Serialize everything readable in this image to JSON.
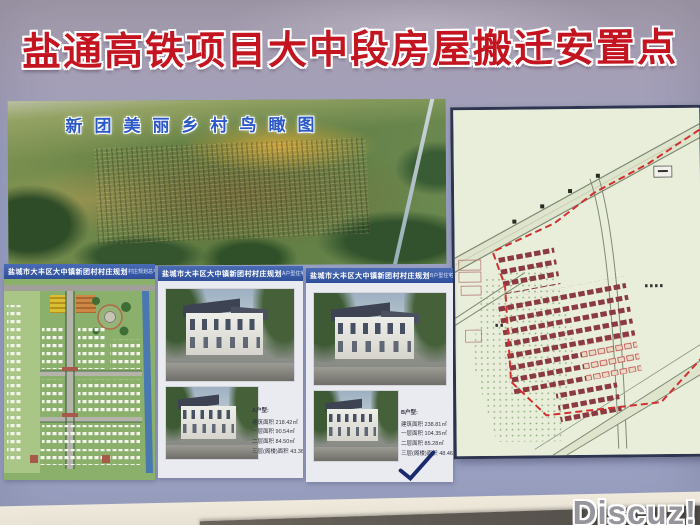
{
  "poster": {
    "title": "盐通高铁项目大中段房屋搬迁安置点",
    "aerial_caption": "新团美丽乡村鸟瞰图",
    "panels": [
      {
        "header": "盐城市大丰区大中镇新团村村庄规划",
        "subheader": "村庄规划总平面图"
      },
      {
        "header": "盐城市大丰区大中镇新团村村庄规划",
        "subheader": "A户型住宅效果图",
        "specs": {
          "label": "A户型:",
          "lines": [
            "建筑面积 218.42㎡",
            "一层面积 90.54㎡",
            "二层面积 84.50㎡",
            "三层(阁楼)面积 43.36㎡"
          ]
        }
      },
      {
        "header": "盐城市大丰区大中镇新团村村庄规划",
        "subheader": "B户型住宅效果图",
        "specs": {
          "label": "B户型:",
          "lines": [
            "建筑面积 238.81㎡",
            "一层面积 104.35㎡",
            "二层面积 85.28㎡",
            "三层(阁楼)面积 48.46㎡"
          ]
        }
      }
    ],
    "annotations": {
      "checkmark": "hand-drawn-check"
    }
  },
  "watermark": "Discuz!",
  "colors": {
    "poster_background": "#9aa0c2",
    "title_red": "#c41420",
    "caption_blue": "#2b59c8",
    "panel_header_blue": "#3558a8",
    "map_paper": "#e9eedb",
    "map_boundary_red": "#d23030",
    "map_house_red": "#8b3a42",
    "plan_green": "#8bb06c",
    "canal_blue": "#4a78b0",
    "watermark_gray": "#95959b"
  }
}
